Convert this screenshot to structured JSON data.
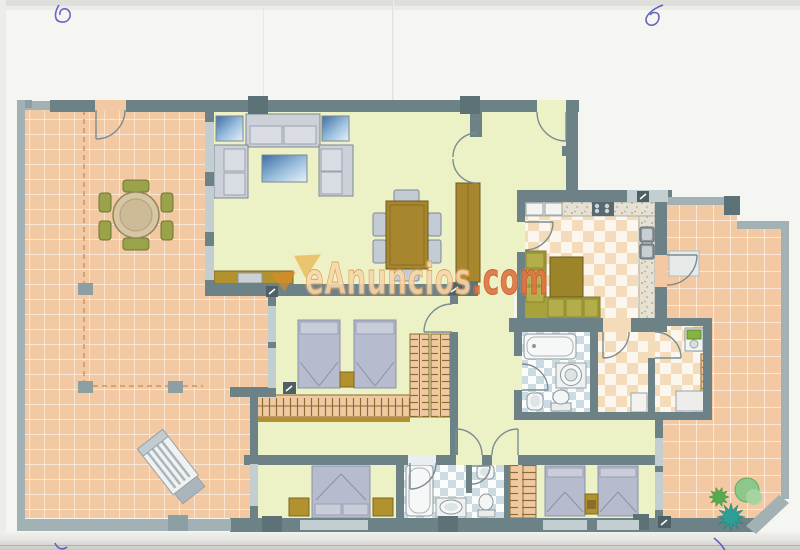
{
  "watermark": {
    "brand": "eAnuncios",
    "suffix": ".com",
    "logo": "bowtie-logo-icon"
  },
  "palette": {
    "paper": "#f5f5f1",
    "wall": "#6d8287",
    "wall_light": "#c3ced0",
    "terrace_wall": "#a2b1b3",
    "floor_interior": "#edf2c6",
    "terrace_tile": "#f3c9a3",
    "kitchen_tile": "#f4dcba",
    "bathroom_tile": "#ccdae1",
    "wood": "#a8862e",
    "mustard": "#b2922f",
    "olive_bench": "#a7a23b",
    "upholstery": "#ccd1d9",
    "bed": "#b6bbce",
    "glass_blue": "#4a74a6",
    "plant_green": "#56ab52",
    "plant_teal": "#2f9e96",
    "pen_ink": "#4a4ab8",
    "watermark_text": "#f3d1a0",
    "watermark_suffix": "#d96a33"
  },
  "rooms": [
    "terrace-left",
    "living-room",
    "entrance-hall",
    "kitchen",
    "inner-hallway",
    "bathroom-main",
    "utility-corridor",
    "laundry-room",
    "terrace-right",
    "bedroom-twin-1",
    "bedroom-master",
    "bathroom-ensuite",
    "bedroom-twin-2"
  ],
  "pen_marks": [
    "top-left-squiggle",
    "top-right-loop",
    "bottom-left-curl",
    "bottom-right-stroke"
  ]
}
